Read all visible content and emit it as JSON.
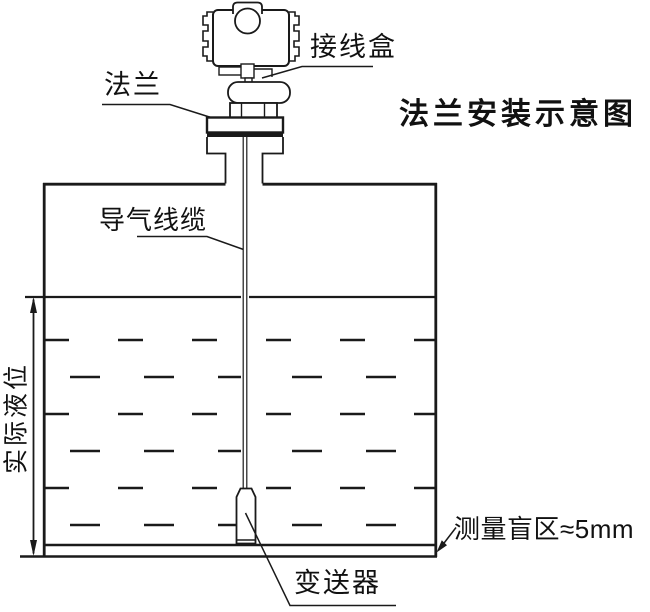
{
  "diagram": {
    "title": "法兰安装示意图",
    "labels": {
      "junction_box": "接线盒",
      "flange": "法兰",
      "air_cable": "导气线缆",
      "actual_level": "实际液位",
      "blind_zone": "测量盲区≈5mm",
      "transmitter": "变送器"
    },
    "colors": {
      "line": "#1a1a1a",
      "background": "#ffffff"
    }
  }
}
